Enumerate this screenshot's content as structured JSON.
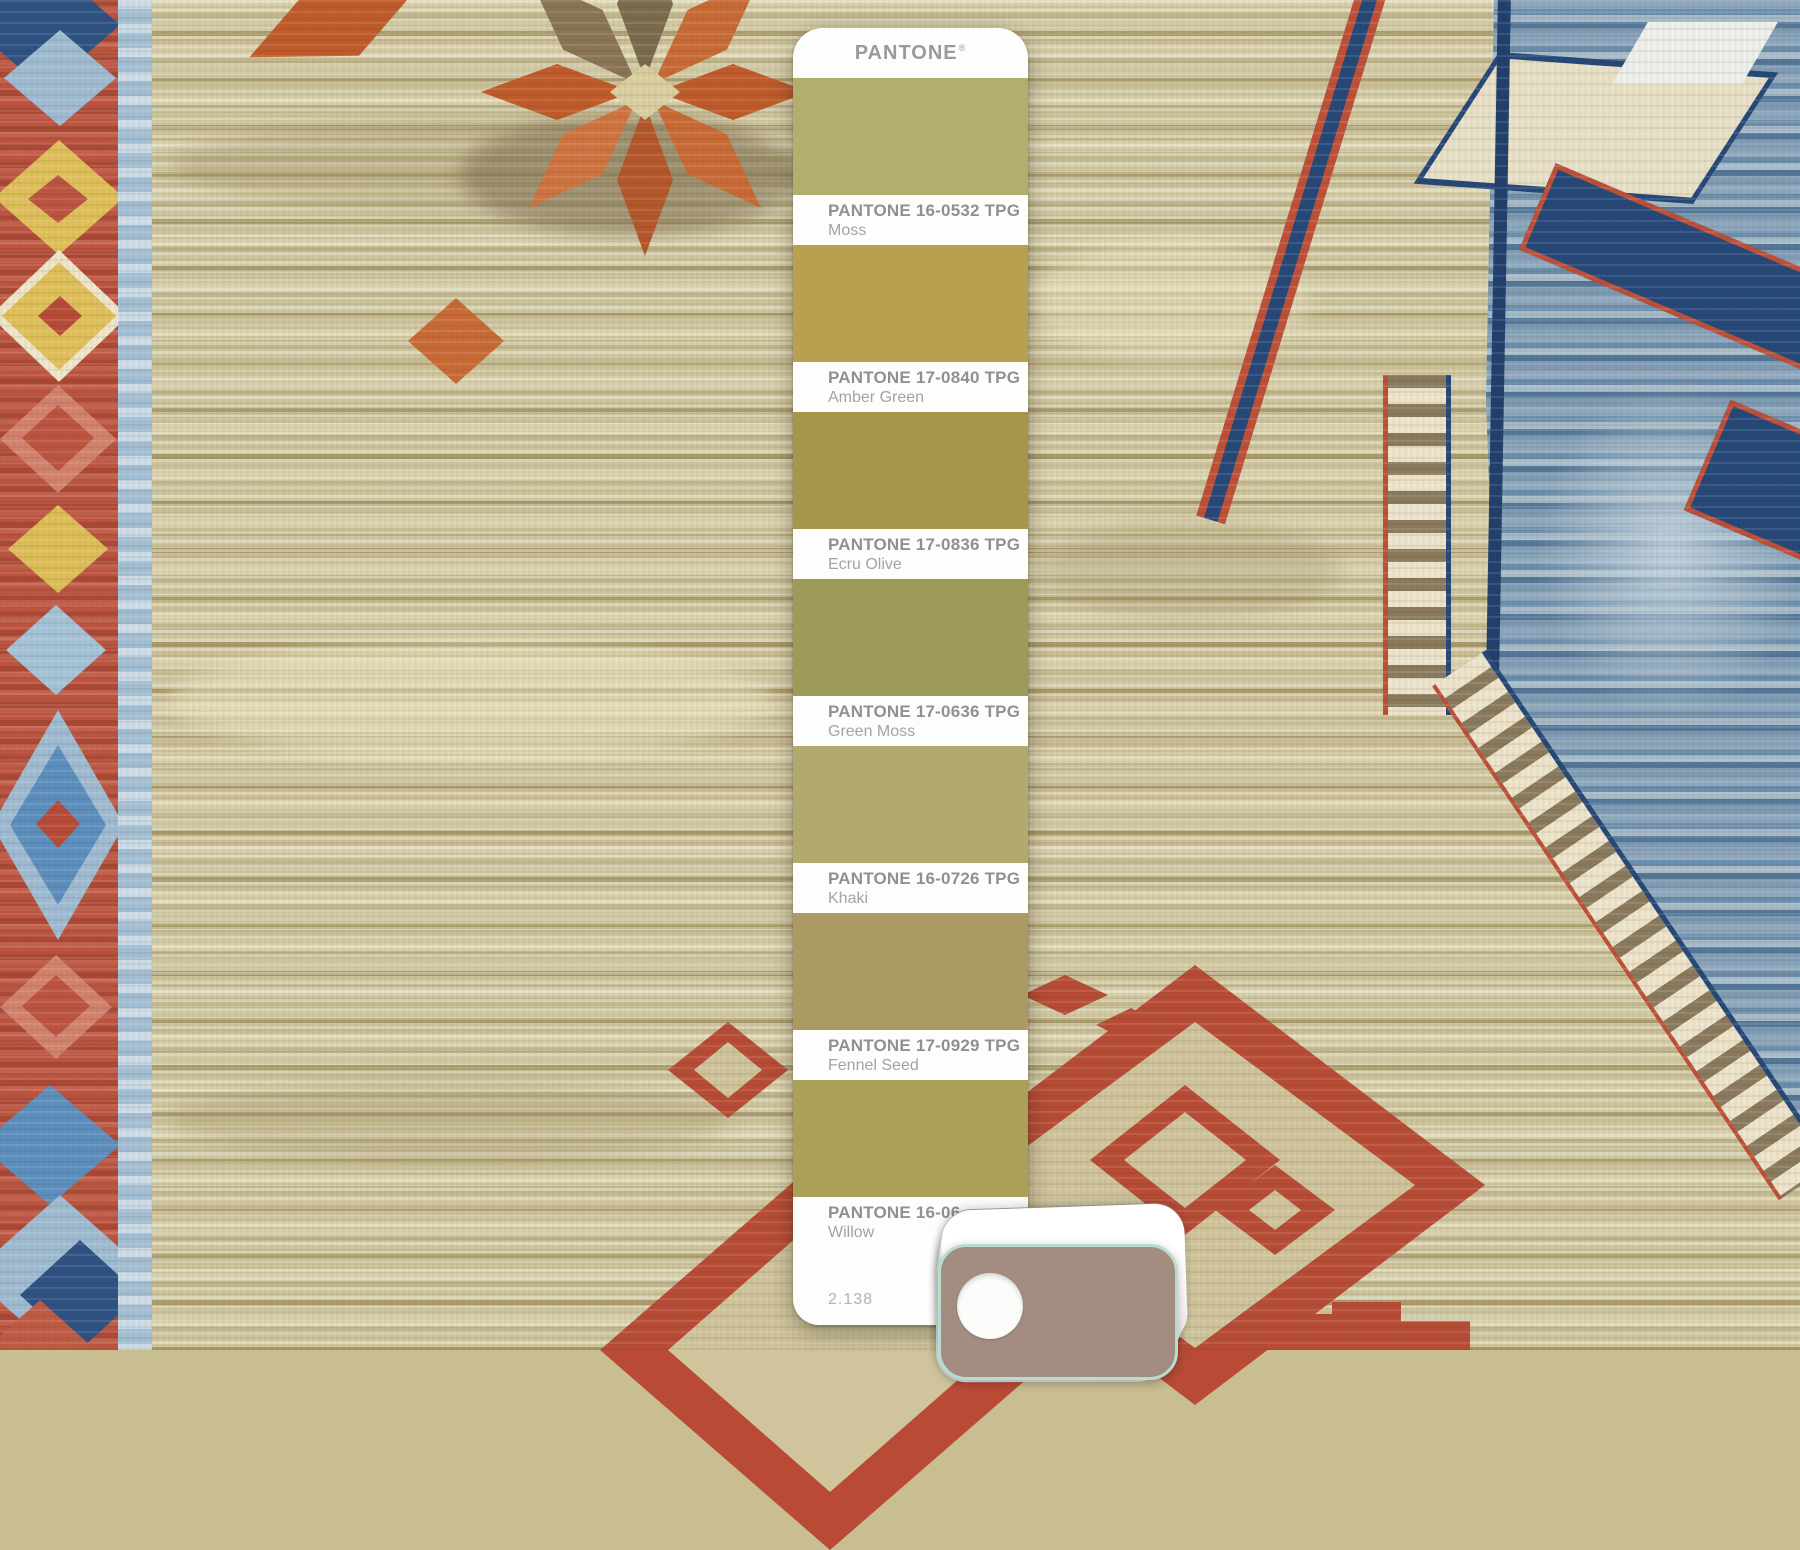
{
  "pantone_strip": {
    "brand": "PANTONE",
    "trademark": "®",
    "page_number": "2.138",
    "swatches": [
      {
        "code": "PANTONE 16-0532 TPG",
        "name": "Moss",
        "hex": "#b2ae6d"
      },
      {
        "code": "PANTONE 17-0840 TPG",
        "name": "Amber Green",
        "hex": "#b7a150"
      },
      {
        "code": "PANTONE 17-0836 TPG",
        "name": "Ecru Olive",
        "hex": "#a6954a"
      },
      {
        "code": "PANTONE 17-0636 TPG",
        "name": "Green Moss",
        "hex": "#9c9b58"
      },
      {
        "code": "PANTONE 16-0726 TPG",
        "name": "Khaki",
        "hex": "#b2a96e"
      },
      {
        "code": "PANTONE 17-0929 TPG",
        "name": "Fennel Seed",
        "hex": "#ac9a64"
      },
      {
        "code": "PANTONE 16-06",
        "name": "Willow",
        "hex": "#aaa058"
      }
    ]
  },
  "swatch_deck": {
    "top_card_hex": "#a38d80",
    "edge_hex": "#b8ddd0"
  },
  "rug_palette": {
    "field": "#c9bd92",
    "border_red": "#bd5340",
    "guard_blue": "#a3bfd6",
    "accent_yellow": "#e0c05a",
    "accent_blue": "#6d94b8",
    "steel_blue": "#5b8fc0",
    "navy": "#24477a",
    "rust": "#bf4f38",
    "medallion_red": "#b94b36"
  }
}
